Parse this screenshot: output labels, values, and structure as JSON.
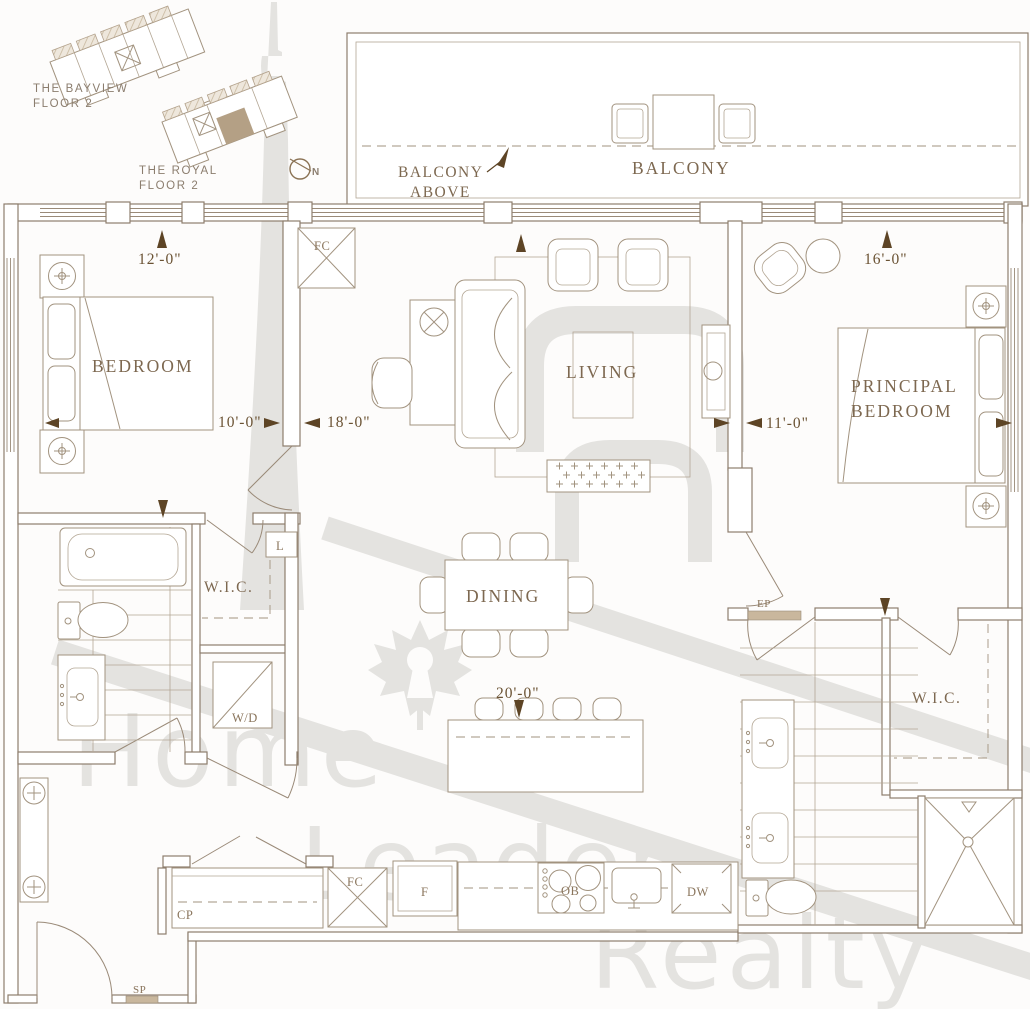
{
  "key_plan": {
    "bayview_name": "THE BAYVIEW",
    "bayview_floor": "FLOOR 2",
    "royal_name": "THE ROYAL",
    "royal_floor": "FLOOR 2",
    "north": "N"
  },
  "balcony": {
    "main_label": "BALCONY",
    "above_line1": "BALCONY",
    "above_line2": "ABOVE"
  },
  "rooms": {
    "bedroom": "BEDROOM",
    "living": "LIVING",
    "dining": "DINING",
    "principal_line1": "PRINCIPAL",
    "principal_line2": "BEDROOM",
    "wic_left": "W.I.C.",
    "wic_right": "W.I.C."
  },
  "dimensions": {
    "bedroom_depth": "12'-0\"",
    "bedroom_width": "10'-0\"",
    "living_width": "18'-0\"",
    "principal_depth": "16'-0\"",
    "principal_width": "11'-0\"",
    "overall_depth": "20'-0\""
  },
  "equipment": {
    "fan_coil_top": "FC",
    "fan_coil_kitchen": "FC",
    "linen": "L",
    "washer_dryer": "W/D",
    "electrical_panel": "EP",
    "coat_closet": "CP",
    "sprinkler": "SP",
    "fridge": "F",
    "oven_burner": "OB",
    "dishwasher": "DW"
  },
  "watermark": {
    "word1": "Home",
    "word2": "Leader",
    "word3": "Realty"
  },
  "colors": {
    "wall_line": "#8e7e6d",
    "furniture_line": "#a2937f",
    "label_text": "#7d6850",
    "dimension_text": "#6a5233",
    "arrow": "#5d4425",
    "highlight_unit": "#b4a085",
    "watermark_gray": "#e4e3e0"
  }
}
